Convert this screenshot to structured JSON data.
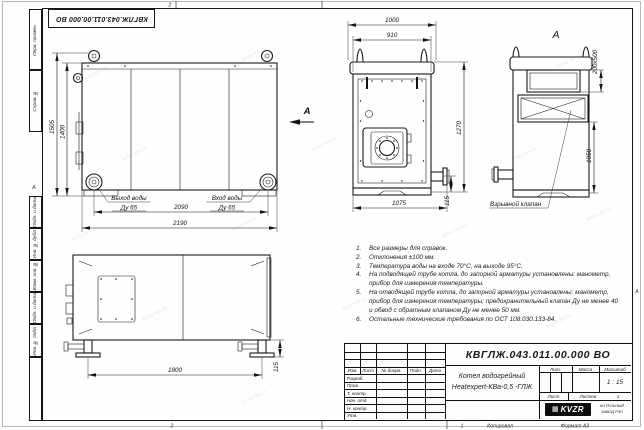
{
  "watermark": {
    "text": "kvzar-tex.ru"
  },
  "frame": {
    "stamp_top": "КВГЛЖ.043.011.00.000 ВО",
    "zone_top": "2",
    "zone_bottom": "2",
    "zone_bottom_right": "1",
    "zone_left": "А",
    "zone_right": "А",
    "left_labels": {
      "perv": "Перв. примен.",
      "sprav": "Справ. №",
      "podp1": "Подп. и дата",
      "inv_dubl": "Инв. № дубл.",
      "vzam": "Взам. инв. №",
      "podp2": "Подп. и дата",
      "inv_podl": "Инв. № подл."
    }
  },
  "front_view": {
    "dim_height_total": "1505",
    "dim_height_body": "1400",
    "dim_width_inner": "2090",
    "dim_width_total": "2190",
    "outlet_label": "Выход воды",
    "outlet_dn": "Ду 65",
    "inlet_label": "Вход воды",
    "inlet_dn": "Ду 65",
    "view_arrow_label": "А"
  },
  "side_view": {
    "dim_top_total": "1000",
    "dim_top_inner": "910",
    "dim_height": "1270",
    "dim_bottom": "1075",
    "dim_stub": "115"
  },
  "view_a": {
    "label": "А",
    "dim_opening": "200х500",
    "dim_height": "1050",
    "callout": "Взрывной клапан"
  },
  "plan_view": {
    "dim_length": "1800",
    "dim_offset": "115"
  },
  "notes": {
    "items": [
      {
        "num": "1.",
        "text": "Все размеры для справок."
      },
      {
        "num": "2.",
        "text": "Отклонения ±100 мм."
      },
      {
        "num": "3.",
        "text": "Температура воды на входе 70°С, на выходе 95°С."
      },
      {
        "num": "4.",
        "text": "На подводящей трубе котла, до запорной арматуры установлены: манометр, прибор для измерения температуры."
      },
      {
        "num": "5.",
        "text": "На отводящей трубе котла, до запорной арматуры установлены: манометр, прибор для измерения температуры; предохранительный клапан Ду не менее 40 и обвод с обратным клапаном Ду не менее 50 мм."
      },
      {
        "num": "6.",
        "text": "Остальные технические требования по ОСТ 108.030.133-84."
      }
    ]
  },
  "title_block": {
    "doc_number": "КВГЛЖ.043.011.00.000 ВО",
    "name_line1": "Котел водогрейный",
    "name_line2": "Heatexpert-КВа-0,5 -ГЛЖ",
    "col_izm": "Изм.",
    "col_list": "Лист",
    "col_docum": "№ докум.",
    "col_podp": "Подп.",
    "col_data": "Дата",
    "rows": [
      "Разраб.",
      "Пров.",
      "Т. контр.",
      "Нач. отд.",
      "Н. контр.",
      "Утв."
    ],
    "lit_label": "Лит.",
    "mass_label": "Масса",
    "scale_label": "Масштаб",
    "scale_value": "1 : 15",
    "sheet_label": "Лист",
    "sheets_label": "Листов",
    "sheets_value": "1",
    "logo_text": "KVZR",
    "org_line1": "КОТЕЛЬНЫЙ",
    "org_line2": "ЗАВОД РЭП",
    "copied_label": "Копировал",
    "format_label": "Формат А3"
  }
}
